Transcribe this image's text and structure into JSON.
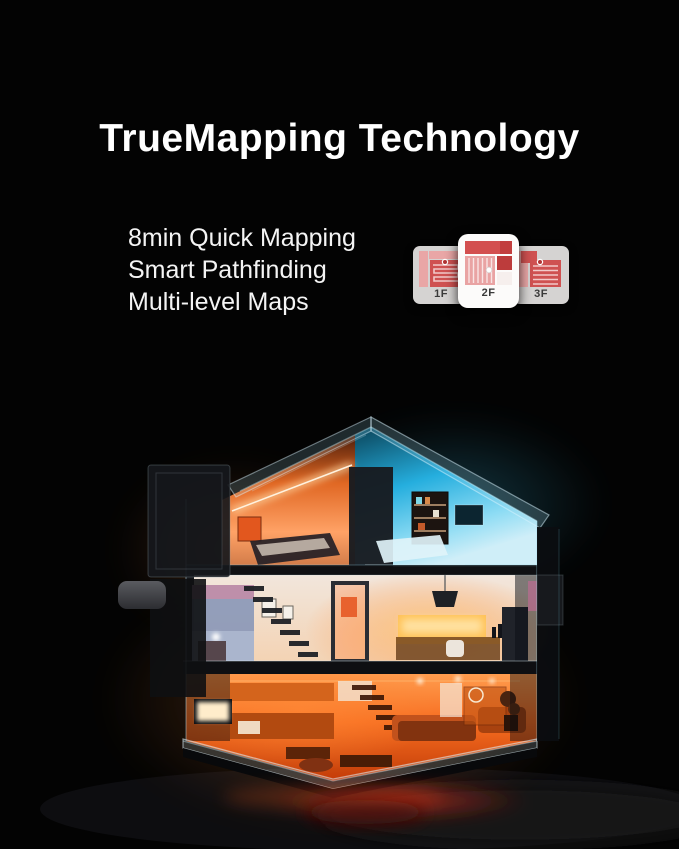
{
  "page": {
    "title": "TrueMapping Technology"
  },
  "features": {
    "items": [
      "8min Quick Mapping",
      "Smart Pathfinding",
      "Multi-level Maps"
    ]
  },
  "floor_maps": {
    "cards": [
      {
        "label": "1F",
        "active": false
      },
      {
        "label": "2F",
        "active": true
      },
      {
        "label": "3F",
        "active": false
      }
    ]
  },
  "colors": {
    "background": "#030303",
    "title_text": "#ffffff",
    "feature_text": "#f4f4f4",
    "card_active_bg": "#fcfbfa",
    "card_inactive_bg": "#d5d3d2",
    "card_label_text": "#3a3a3a",
    "map_red": "#cf5151",
    "map_dark_red": "#bd3c3c",
    "map_pink": "#e9a6a6",
    "house_warm_glow": "#ff7a2e",
    "house_cool_glow": "#2ab5e6",
    "ground_glow_red": "#8c1d12"
  }
}
